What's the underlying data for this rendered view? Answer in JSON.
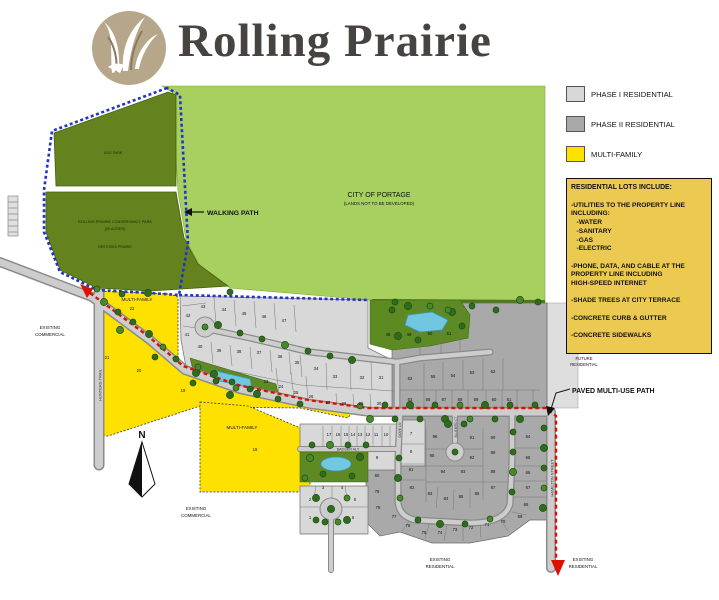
{
  "header": {
    "title": "Rolling Prairie"
  },
  "legend": {
    "items": [
      {
        "label": "PHASE I RESIDENTIAL",
        "color": "#d8d8d8"
      },
      {
        "label": "PHASE II RESIDENTIAL",
        "color": "#a9a9a9"
      },
      {
        "label": "MULTI-FAMILY",
        "color": "#ffe100"
      }
    ]
  },
  "info_box": {
    "title": "RESIDENTIAL LOTS INCLUDE:",
    "lines": [
      "",
      "-UTILITIES TO THE PROPERTY LINE",
      "INCLUDING:",
      "   -WATER",
      "   -SANITARY",
      "   -GAS",
      "   -ELECTRIC",
      "",
      "-PHONE, DATA, AND CABLE AT THE",
      "PROPERTY LINE INCLUDING",
      "HIGH-SPEED INTERNET",
      "",
      "-SHADE TREES AT CITY TERRACE",
      "",
      "-CONCRETE CURB & GUTTER",
      "",
      "-CONCRETE SIDEWALKS"
    ]
  },
  "labels": {
    "city": {
      "l1": "CITY OF PORTAGE",
      "l2": "(LANDS NOT TO BE DEVELOPED)"
    },
    "dog_park": "DOG PARK",
    "conservancy": {
      "l1": "ROLLING PRAIRIE CONSERVANCY PARK",
      "l2": "(20 ACRES)",
      "l3": "RESTORED PRAIRIE"
    },
    "walking_path": "WALKING PATH",
    "paved_path": "PAVED MULTI-USE PATH",
    "multi_family": "MULTI-FAMILY",
    "existing_commercial": {
      "l1": "EXISTING",
      "l2": "COMMERCIAL"
    },
    "existing_residential": {
      "l1": "EXISTING",
      "l2": "RESIDENTIAL"
    },
    "future_residential": {
      "l1": "FUTURE",
      "l2": "RESIDENTIAL"
    },
    "north": "N"
  },
  "streets": {
    "hunters_trail": "HUNTERS TRAIL",
    "hamilton_street": "HAMILTON STREET",
    "badger_aly": "BADGER ALY",
    "dove_ln": "DOVE LN",
    "bluebird_ct": "BLUEBIRD CT"
  },
  "colors": {
    "phase1": "#d8d8d8",
    "phase2": "#a9a9a9",
    "multi_family": "#ffe100",
    "city_green": "#a8d05e",
    "park_green": "#64821d",
    "info_bg": "#ecca52",
    "path_red": "#dd1100",
    "path_blue": "#2233cc",
    "road": "#cdcdcd",
    "pond": "#72c7e0",
    "tree": "#2f6d1d",
    "logo_tan": "#b6a68a"
  },
  "lots": {
    "phase1": [
      [
        1,
        310,
        519
      ],
      [
        2,
        310,
        501
      ],
      [
        3,
        323,
        489
      ],
      [
        4,
        342,
        489
      ],
      [
        5,
        355,
        501
      ],
      [
        6,
        353,
        519
      ],
      [
        7,
        411,
        435
      ],
      [
        8,
        411,
        453
      ],
      [
        9,
        377,
        459
      ],
      [
        10,
        386,
        436
      ],
      [
        11,
        376,
        436
      ],
      [
        12,
        368,
        436
      ],
      [
        13,
        360,
        436
      ],
      [
        14,
        353,
        436
      ],
      [
        15,
        346,
        436
      ],
      [
        16,
        338,
        436
      ],
      [
        17,
        329,
        436
      ],
      [
        23,
        266,
        383
      ],
      [
        24,
        281,
        388
      ],
      [
        25,
        296,
        394
      ],
      [
        26,
        311,
        398
      ],
      [
        27,
        328,
        404
      ],
      [
        28,
        344,
        405
      ],
      [
        29,
        361,
        405
      ],
      [
        30,
        379,
        405
      ],
      [
        31,
        381,
        379
      ],
      [
        32,
        362,
        379
      ],
      [
        33,
        335,
        378
      ],
      [
        34,
        316,
        370
      ],
      [
        35,
        297,
        364
      ],
      [
        36,
        280,
        358
      ],
      [
        37,
        259,
        354
      ],
      [
        38,
        239,
        353
      ],
      [
        39,
        219,
        352
      ],
      [
        40,
        200,
        348
      ],
      [
        41,
        187,
        336
      ],
      [
        42,
        188,
        317
      ],
      [
        43,
        203,
        308
      ],
      [
        44,
        224,
        311
      ],
      [
        45,
        244,
        315
      ],
      [
        46,
        264,
        318
      ],
      [
        47,
        284,
        322
      ]
    ],
    "phase2": [
      [
        48,
        388,
        336
      ],
      [
        49,
        409,
        336
      ],
      [
        50,
        430,
        335
      ],
      [
        51,
        449,
        335
      ],
      [
        52,
        493,
        373
      ],
      [
        53,
        472,
        374
      ],
      [
        54,
        453,
        377
      ],
      [
        55,
        433,
        378
      ],
      [
        56,
        428,
        401
      ],
      [
        57,
        444,
        401
      ],
      [
        58,
        460,
        401
      ],
      [
        59,
        476,
        401
      ],
      [
        60,
        494,
        401
      ],
      [
        61,
        509,
        401
      ],
      [
        62,
        410,
        380
      ],
      [
        63,
        410,
        401
      ],
      [
        64,
        528,
        438
      ],
      [
        65,
        528,
        459
      ],
      [
        66,
        528,
        474
      ],
      [
        67,
        528,
        489
      ],
      [
        68,
        526,
        506
      ],
      [
        69,
        520,
        518
      ],
      [
        70,
        503,
        523
      ],
      [
        71,
        487,
        526
      ],
      [
        72,
        471,
        529
      ],
      [
        73,
        455,
        531
      ],
      [
        74,
        440,
        534
      ],
      [
        75,
        424,
        534
      ],
      [
        76,
        408,
        527
      ],
      [
        77,
        394,
        518
      ],
      [
        78,
        378,
        509
      ],
      [
        79,
        377,
        493
      ],
      [
        80,
        377,
        477
      ],
      [
        81,
        411,
        471
      ],
      [
        82,
        412,
        489
      ],
      [
        83,
        430,
        495
      ],
      [
        84,
        446,
        500
      ],
      [
        85,
        461,
        498
      ],
      [
        86,
        477,
        495
      ],
      [
        87,
        493,
        489
      ],
      [
        88,
        493,
        473
      ],
      [
        89,
        493,
        454
      ],
      [
        90,
        493,
        439
      ],
      [
        91,
        472,
        439
      ],
      [
        92,
        472,
        459
      ],
      [
        93,
        463,
        473
      ],
      [
        94,
        443,
        473
      ],
      [
        95,
        432,
        457
      ],
      [
        96,
        435,
        438
      ]
    ],
    "multi_family": [
      [
        18,
        255,
        451
      ],
      [
        19,
        183,
        392
      ],
      [
        20,
        139,
        372
      ],
      [
        21,
        107,
        359
      ],
      [
        22,
        132,
        310
      ]
    ]
  }
}
